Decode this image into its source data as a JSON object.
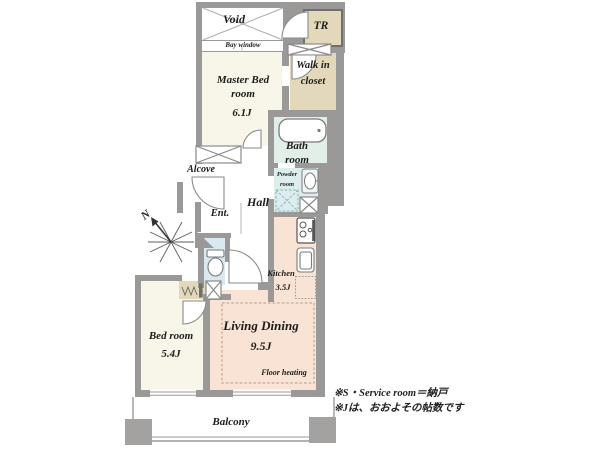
{
  "plan": {
    "rooms": {
      "void": {
        "label": "Void"
      },
      "tr": {
        "label": "TR"
      },
      "bay_window": {
        "label": "Bay window"
      },
      "master_bedroom": {
        "name": "Master Bed room",
        "size": "6.1J"
      },
      "walk_in_closet": {
        "label": "Walk in closet"
      },
      "bath_room": {
        "label": "Bath room"
      },
      "powder_room": {
        "label": "Powder room"
      },
      "alcove": {
        "label": "Alcove"
      },
      "entrance": {
        "label": "Ent."
      },
      "hall": {
        "label": "Hall"
      },
      "kitchen": {
        "name": "Kitchen",
        "size": "3.5J"
      },
      "living_dining": {
        "name": "Living Dining",
        "size": "9.5J",
        "floor_note": "Floor heating"
      },
      "bedroom": {
        "name": "Bed room",
        "size": "5.4J"
      },
      "balcony": {
        "label": "Balcony"
      }
    },
    "compass": {
      "label": "N"
    },
    "notes": {
      "line1": "※S・Service room＝納戸",
      "line2": "※Jは、おおよその帖数です"
    },
    "colors": {
      "wall": "#9a9998",
      "room_cream": "#f8f6e8",
      "closet_beige": "#e3d8b9",
      "bath_green": "#e2eee8",
      "powder_blue": "#ddedee",
      "toilet_blue": "#d8eaf0",
      "ld_peach": "#f9e3d5",
      "text": "#1c1c1c"
    }
  }
}
